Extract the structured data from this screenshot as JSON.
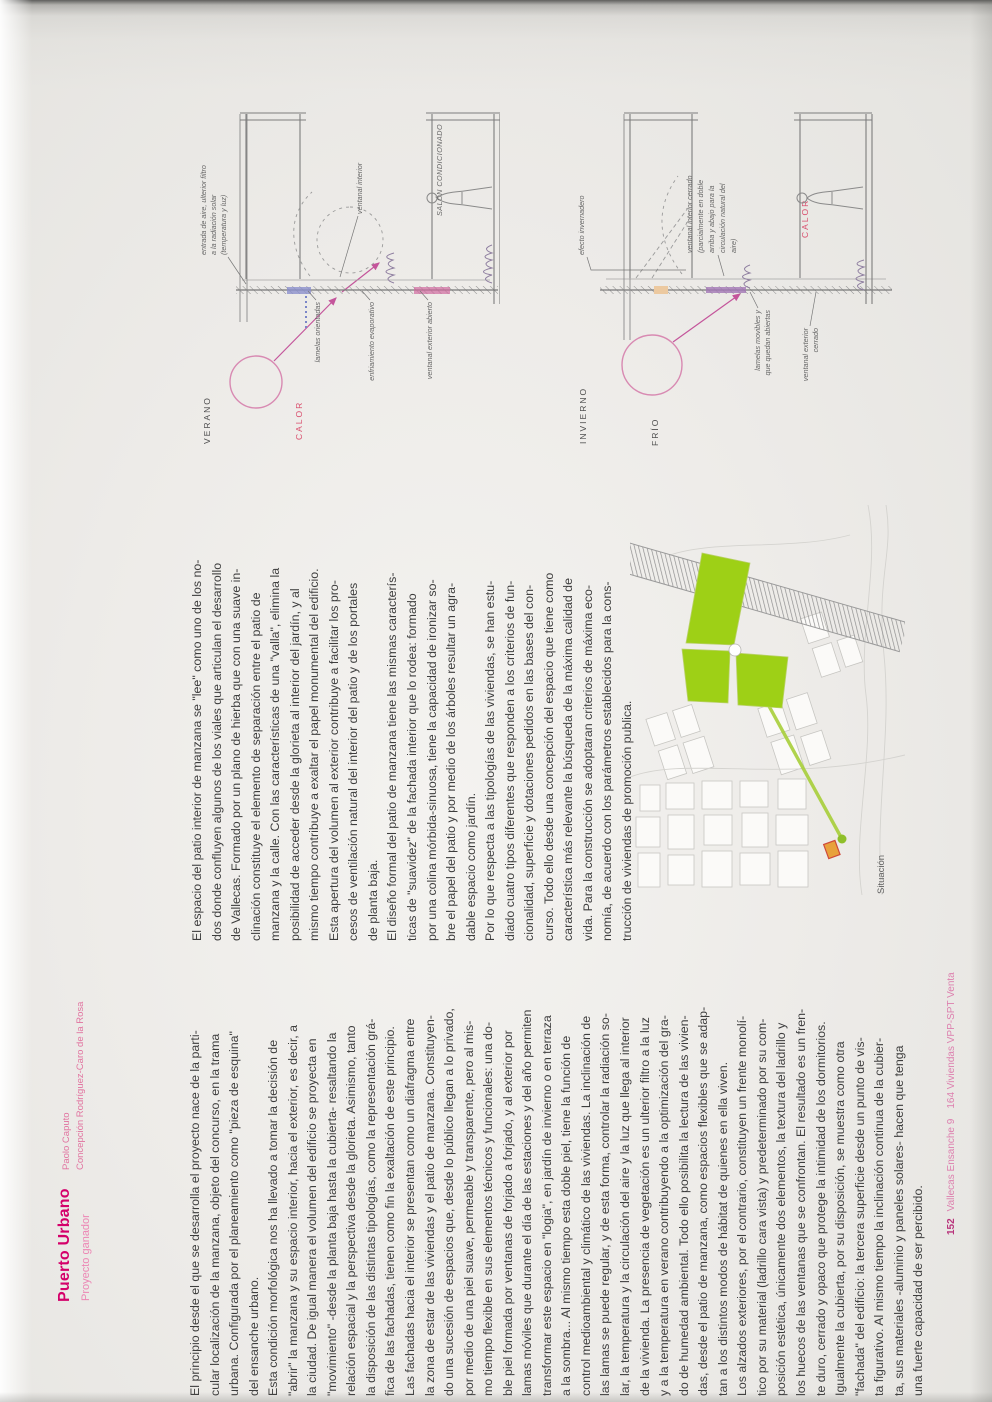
{
  "header": {
    "title": "Puerto Urbano",
    "subtitle": "Proyecto ganador",
    "authors": [
      "Paolo Caputo",
      "Concepción Rodríguez-Caro de la Rosa"
    ]
  },
  "body": {
    "col1": [
      "El principio desde el que se desarrolla el proyecto nace de la parti-",
      "cular localización de la manzana, objeto del concurso, en la trama",
      "urbana. Configurada por el planeamiento como \"pieza de esquina\"",
      "del ensanche urbano.",
      "Esta condición morfológica nos ha llevado a tomar la decisión de",
      "\"abrir\" la manzana y su espacio interior, hacia el exterior, es decir, a",
      "la ciudad. De igual manera el volumen del edificio se proyecta en",
      "\"movimiento\" -desde la planta baja hasta la cubierta- resaltando la",
      "relación espacial y la perspectiva desde la glorieta. Asimismo, tanto",
      "la disposición de las distintas tipologías, como la representación grá-",
      "fica de las fachadas, tienen como fin la exaltación de este principio.",
      "Las fachadas hacia el interior se presentan como un diafragma entre",
      "la zona de estar de las viviendas y el patio de manzana. Constituyen-",
      "do una sucesión de espacios que, desde lo público llegan a lo privado,",
      "por medio de una piel suave, permeable y transparente, pero al mis-",
      "mo tiempo flexible en sus elementos técnicos y funcionales: una do-",
      "ble piel formada por ventanas de forjado a forjado, y al exterior por",
      "lamas móviles que durante el día de las estaciones y del año permiten",
      "transformar este espacio en \"logia\", en jardín de invierno o en terraza",
      "a la sombra... Al mismo tiempo esta doble piel, tiene la función de",
      "control medioambiental y climático de las viviendas. La inclinación de",
      "las lamas se puede regular, y de esta forma, controlar la radiación so-",
      "lar, la temperatura y la circulación del aire y la luz que llega al interior",
      "de la vivienda. La presencia de vegetación es un ulterior filtro a la luz",
      "y a la temperatura en verano contribuyendo a la optimización del gra-",
      "do de humedad ambiental. Todo ello posibilita la lectura de las vivien-",
      "das, desde el patio de manzana, como espacios flexibles que se adap-",
      "tan a los distintos modos de hábitat de quienes en ella viven.",
      "Los alzados exteriores, por el contrario, constituyen un frente monolí-",
      "tico por su material (ladrillo cara vista) y predeterminado por su com-",
      "posición estética, únicamente dos elementos, la textura del ladrillo y",
      "los huecos de las ventanas que se confrontan. El resultado es un fren-",
      "te duro, cerrado y opaco que protege la intimidad de los dormitorios.",
      "Igualmente la cubierta, por su disposición, se muestra como otra",
      "\"fachada\" del edificio: la tercera superficie desde un punto de vis-",
      "ta figurativo. Al mismo tiempo la inclinación continua de la cubier-",
      "ta, sus materiales -aluminio y paneles solares- hacen que tenga",
      "una fuerte capacidad de ser percibido."
    ],
    "col2": [
      "El espacio del patio interior de manzana se \"lee\" como uno de los no-",
      "dos donde confluyen algunos de los viales que articulan el desarrollo",
      "de Vallecas. Formado por un plano de hierba que con una suave in-",
      "clinación constituye el elemento de separación entre el patio de",
      "manzana y la calle. Con las características de una \"valla\", elimina la",
      "posibilidad de acceder desde la glorieta al interior del jardín, y al",
      "mismo tiempo contribuye a exaltar el papel monumental del edificio.",
      "Esta apertura del volumen al exterior contribuye a facilitar los pro-",
      "cesos de ventilación natural del interior del patio y de los portales",
      "de planta baja.",
      "El diseño formal del patio de manzana tiene las mismas caracterís-",
      "ticas de \"suavidez\" de la fachada interior que lo rodea: formado",
      "por una colina mórbida-sinuosa, tiene la capacidad de ironizar so-",
      "bre el papel del patio y por medio de los árboles resultar un agra-",
      "dable espacio como jardín.",
      "Por lo que respecta a las tipologías de las viviendas, se han estu-",
      "diado cuatro tipos diferentes que responden a los criterios de fun-",
      "cionalidad, superficie y dotaciones pedidos en las bases del con-",
      "curso. Todo ello desde una concepción del espacio que tiene como",
      "característica más relevante la búsqueda de la máxima calidad de",
      "vida. Para la construcción se adoptaran criterios de máxima eco-",
      "nomía, de acuerdo con los parámetros establecidos para la cons-",
      "trucción de viviendas de promoción publica."
    ]
  },
  "sketches": {
    "summer": {
      "season": "VERANO",
      "temp": "CALOR",
      "sun_note": [
        "entrada de aire, ulterior filtro",
        "a la radiación solar",
        "(temperatura y luz)"
      ],
      "label_louvers": "lamelas orientadas",
      "label_cooling": "enfriamiento evaporativo",
      "label_ext_window": "ventanal exterior abierto",
      "label_int_window": "ventanal interior",
      "label_room": "SALÓN CONDICIONADO"
    },
    "winter": {
      "season": "INVIERNO",
      "temp": "FRÍO",
      "heat": "CALOR",
      "label_greenhouse": "efecto invernadero",
      "note": [
        "ventanal interior cerrado",
        "(parcialmente en doble",
        "arriba y abajo para la",
        "circulación natural del",
        "aire)"
      ],
      "label_louvers": [
        "lamelas movibles y",
        "que quedan abiertas"
      ],
      "label_ext_window": [
        "ventanal exterior",
        "cerrado"
      ]
    }
  },
  "map": {
    "caption": "Situación"
  },
  "footer": {
    "page_number": "152",
    "book_title": "Vallecas Ensanche 9",
    "project_ref": "164 Viviendas VPP-SPT Venta"
  },
  "colors": {
    "accent_magenta": "#d4006a",
    "pink": "#e1729f",
    "sketch_red": "#d94f6e",
    "map_green": "#9ed016"
  }
}
